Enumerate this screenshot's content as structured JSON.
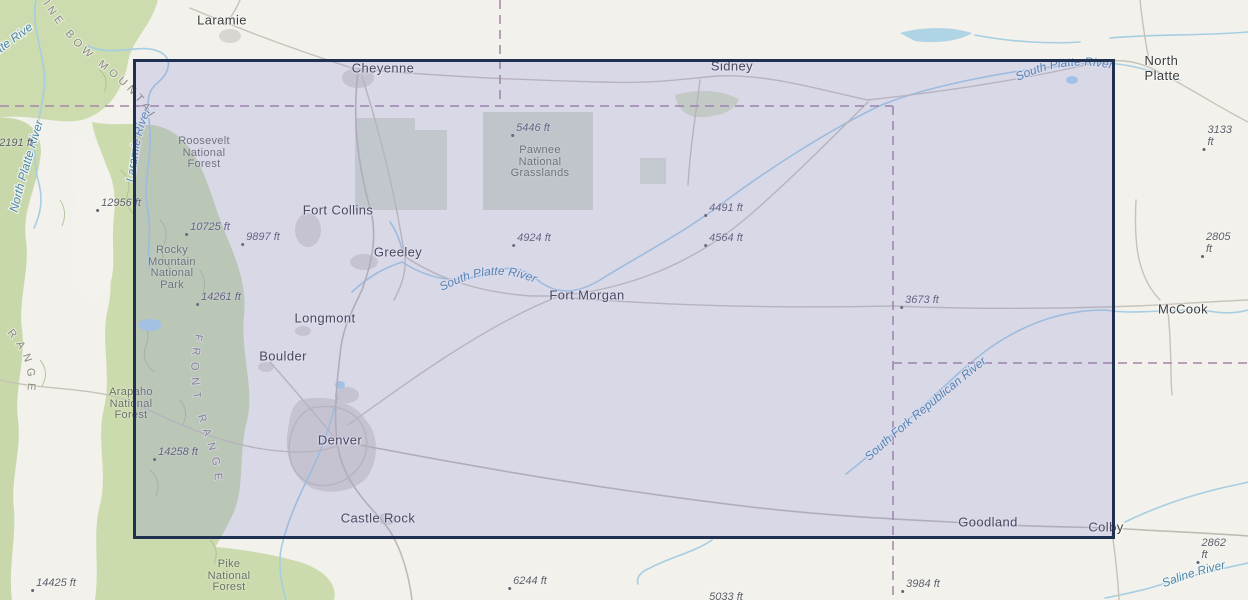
{
  "map": {
    "selection_rectangle": {
      "x": 133,
      "y": 59,
      "width": 982,
      "height": 480,
      "fill_color": "#7a7ad6",
      "fill_opacity": 0.21,
      "border_color": "#1f3050"
    },
    "colors": {
      "base_land": "#f2f1eb",
      "forest_green": "#ccdbae",
      "grassland_overlay": "#ccd5c2",
      "water": "#a6cee2",
      "water_label": "#4e86a8",
      "road": "#c7c3b9",
      "urban_area": "#d9d6d2",
      "dashed_boundary": "#a98ca9",
      "city_text": "#3c3c3c",
      "elevation_text": "#5e5e6a",
      "area_text": "#6b7162",
      "range_text": "#8a8880"
    },
    "labels": {
      "cities": [
        {
          "text": "Laramie",
          "x": 222,
          "y": 20
        },
        {
          "text": "Cheyenne",
          "x": 383,
          "y": 68
        },
        {
          "text": "Sidney",
          "x": 732,
          "y": 66
        },
        {
          "text": "North Platte",
          "x": 1179,
          "y": 68
        },
        {
          "text": "Fort Collins",
          "x": 338,
          "y": 210
        },
        {
          "text": "Greeley",
          "x": 398,
          "y": 252
        },
        {
          "text": "Fort Morgan",
          "x": 587,
          "y": 295
        },
        {
          "text": "Longmont",
          "x": 325,
          "y": 318
        },
        {
          "text": "Boulder",
          "x": 283,
          "y": 356
        },
        {
          "text": "Denver",
          "x": 340,
          "y": 440
        },
        {
          "text": "Castle Rock",
          "x": 378,
          "y": 518
        },
        {
          "text": "McCook",
          "x": 1183,
          "y": 309
        },
        {
          "text": "Goodland",
          "x": 988,
          "y": 522
        },
        {
          "text": "Colby",
          "x": 1106,
          "y": 527
        }
      ],
      "elevations": [
        {
          "text": "5446 ft",
          "x": 533,
          "y": 128
        },
        {
          "text": "2191 ft",
          "x": 16,
          "y": 143
        },
        {
          "text": "3133 ft",
          "x": 1221,
          "y": 136
        },
        {
          "text": "12956 ft",
          "x": 121,
          "y": 203
        },
        {
          "text": "10725 ft",
          "x": 210,
          "y": 227
        },
        {
          "text": "9897 ft",
          "x": 263,
          "y": 237
        },
        {
          "text": "4924 ft",
          "x": 534,
          "y": 238
        },
        {
          "text": "4491 ft",
          "x": 726,
          "y": 208
        },
        {
          "text": "4564 ft",
          "x": 726,
          "y": 238
        },
        {
          "text": "2805 ft",
          "x": 1220,
          "y": 243
        },
        {
          "text": "14261 ft",
          "x": 221,
          "y": 297
        },
        {
          "text": "3673 ft",
          "x": 922,
          "y": 300
        },
        {
          "text": "14258 ft",
          "x": 178,
          "y": 452
        },
        {
          "text": "14425 ft",
          "x": 56,
          "y": 583
        },
        {
          "text": "6244 ft",
          "x": 530,
          "y": 581
        },
        {
          "text": "5033 ft",
          "x": 726,
          "y": 597
        },
        {
          "text": "3984 ft",
          "x": 923,
          "y": 584
        },
        {
          "text": "2862 ft",
          "x": 1217,
          "y": 549
        }
      ],
      "areas": [
        {
          "lines": [
            "Roosevelt",
            "National",
            "Forest"
          ],
          "x": 204,
          "y": 153
        },
        {
          "lines": [
            "Pawnee",
            "National",
            "Grasslands"
          ],
          "x": 540,
          "y": 162
        },
        {
          "lines": [
            "Rocky",
            "Mountain",
            "National",
            "Park"
          ],
          "x": 172,
          "y": 268
        },
        {
          "lines": [
            "Arapaho",
            "National",
            "Forest"
          ],
          "x": 131,
          "y": 404
        },
        {
          "lines": [
            "Pike",
            "National",
            "Forest"
          ],
          "x": 229,
          "y": 576
        }
      ],
      "rivers": [
        {
          "text": "Laramie River"
        },
        {
          "text": "North Platte River"
        },
        {
          "text": "North Platte River"
        },
        {
          "text": "South Platte River"
        },
        {
          "text": "South Platte River"
        },
        {
          "text": "South Fork Republican River"
        },
        {
          "text": "Saline River"
        }
      ],
      "ranges": [
        {
          "text": "MEDICINE BOW MOUNTAINS"
        },
        {
          "text": "FRONT RANGE"
        },
        {
          "text": "RANGE"
        }
      ]
    }
  }
}
